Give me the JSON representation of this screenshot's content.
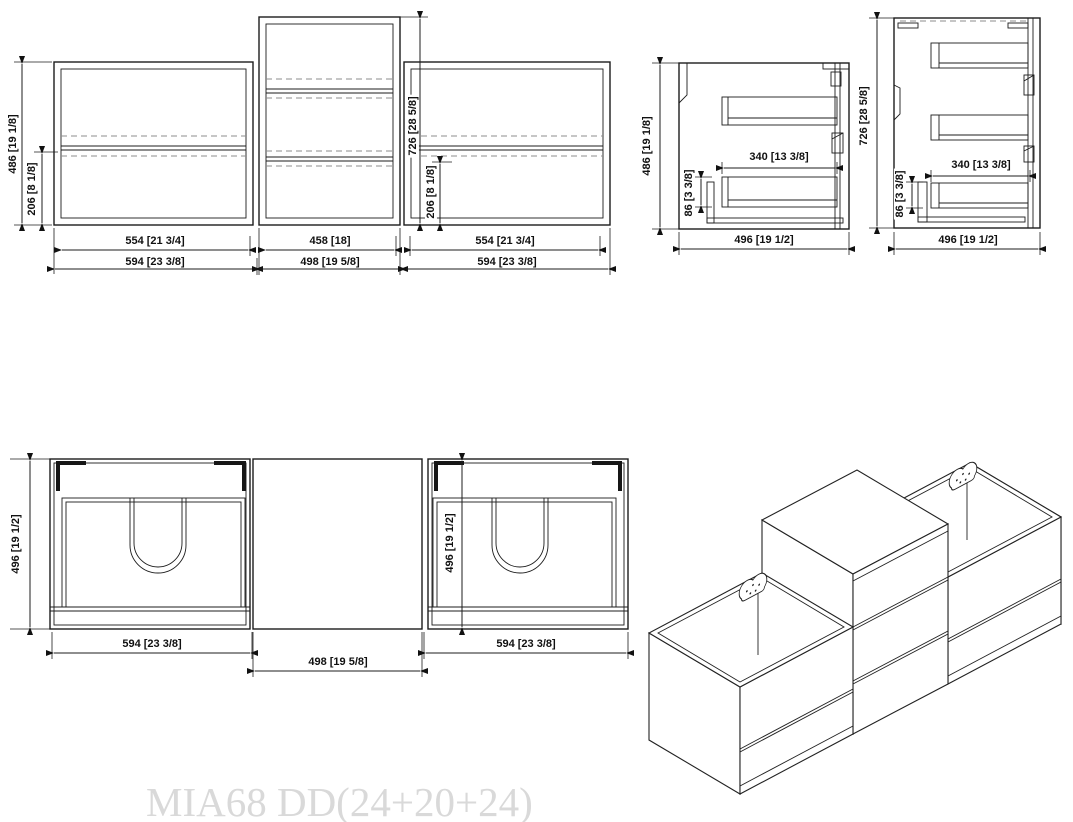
{
  "watermark": "MIA68 DD(24+20+24)",
  "front": {
    "w_cab_left": "554 [21 3/4]",
    "w_cab_center": "458 [18]",
    "w_cab_right": "554 [21 3/4]",
    "w_top_left": "594 [23 3/8]",
    "w_top_center": "498 [19 5/8]",
    "w_top_right": "594 [23 3/8]",
    "h_side": "486 [19 1/8]",
    "h_drawer_left": "206 [8 1/8]",
    "h_center": "726 [28 5/8]",
    "h_drawer_right": "206 [8 1/8]"
  },
  "side_small": {
    "height": "486 [19 1/8]",
    "rail_length": "340 [13 3/8]",
    "bottom_offset": "86 [3 3/8]",
    "depth": "496 [19 1/2]"
  },
  "side_tall": {
    "height": "726 [28 5/8]",
    "rail_length": "340 [13 3/8]",
    "bottom_offset": "86 [3 3/8]",
    "depth": "496 [19 1/2]"
  },
  "plan": {
    "depth_left": "496 [19 1/2]",
    "depth_right": "496 [19 1/2]",
    "w_left": "594 [23 3/8]",
    "w_center": "498 [19 5/8]",
    "w_right": "594 [23 3/8]"
  }
}
